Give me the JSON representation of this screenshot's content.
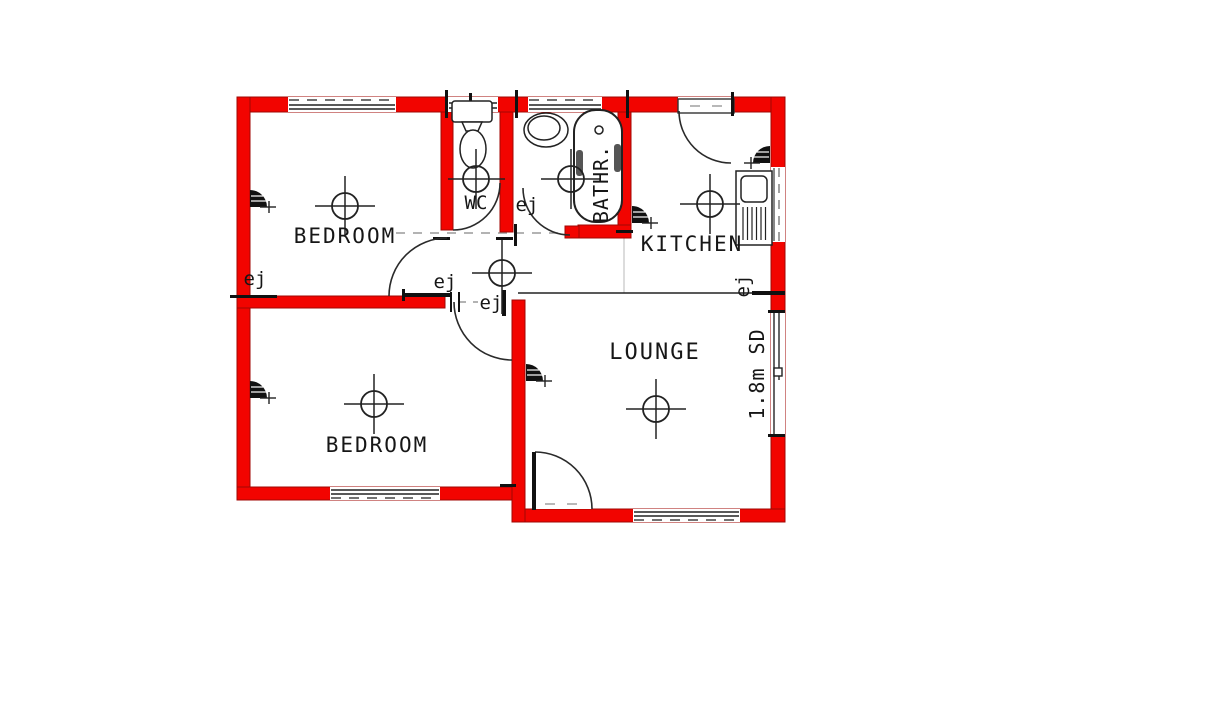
{
  "plan": {
    "rooms": {
      "bedroom_top": "BEDROOM",
      "bedroom_bottom": "BEDROOM",
      "wc": "WC",
      "bathroom": "BATHR.",
      "kitchen": "KITCHEN",
      "lounge": "LOUNGE"
    },
    "annotations": {
      "ej": "ej",
      "sliding_door": "1.8m SD"
    },
    "colors": {
      "wall_red": "#f20400",
      "wall_edge": "#a00703",
      "line_black": "#1a1a1a",
      "dash_gray": "#999999"
    }
  }
}
